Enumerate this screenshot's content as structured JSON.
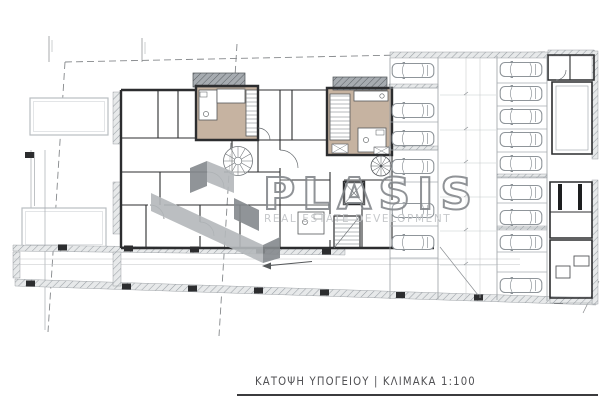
{
  "page": {
    "width": 600,
    "height": 400,
    "background": "#ffffff"
  },
  "watermark": {
    "brand": "PLASIS",
    "tagline": "REAL ESTATE DEVELOPMENT",
    "brand_outline_color": "#84888c",
    "tagline_color": "#c0c3c6",
    "mark_light_color": "#b4b8bb",
    "mark_dark_color": "#85898d"
  },
  "title_block": {
    "caption": "ΚΑΤΟΨΗ ΥΠΟΓΕΙΟΥ | ΚΛΙΜΑΚΑ 1:100",
    "plan_name": "ΚΑΤΟΨΗ ΥΠΟΓΕΙΟΥ",
    "scale_label": "ΚΛΙΜΑΚΑ 1:100",
    "underline_color": "#3b3b3d"
  },
  "drawing": {
    "kind": "basement floor plan",
    "colors": {
      "walls": "#2c2d2f",
      "hatch_wall_bg": "#e7e9ea",
      "planter_hatch_bg": "#a6abb0",
      "unit_floor_tan": "#c6b3a1",
      "car_outline": "#8f959a",
      "boundary_dash": "#85888b"
    },
    "parking": {
      "middle_column": {
        "x": 391,
        "car_y_tops": [
          62,
          102,
          130,
          158,
          202,
          234
        ]
      },
      "right_column": {
        "x": 499,
        "car_y_tops": [
          61,
          85,
          108,
          131,
          155,
          184,
          209,
          234,
          277
        ]
      },
      "total_cars": 15
    }
  }
}
